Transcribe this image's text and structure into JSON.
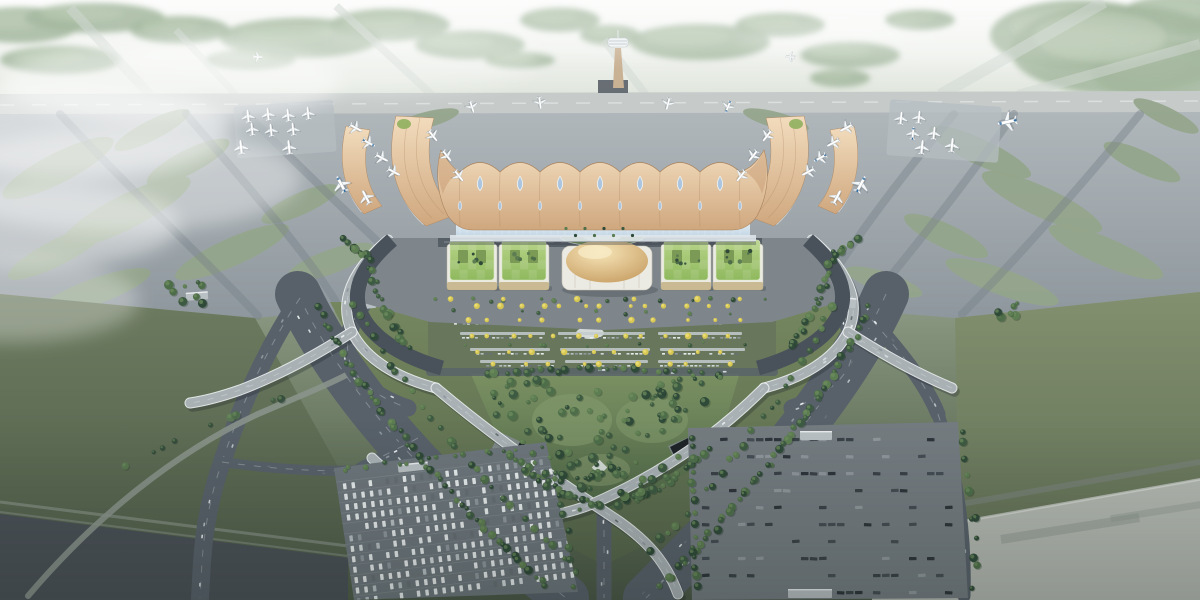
{
  "meta": {
    "description": "Aerial rendering of an airport: wavy gold-roofed terminal with teardrop skylights, curved gold piers with parked jets, golden dome and green-roof landside buildings, tree-lined V-shaped approach roads and flyovers, car park, bus depot, runways and green airfield"
  },
  "palette": {
    "runway": "#c6cbca",
    "apron_top": "#b0b7bb",
    "apron_bottom": "#8e979d",
    "infield": "#94a58b",
    "taxiway": "#78828a",
    "roof_hi": "#f2dcbd",
    "roof": "#cfa77e",
    "roof_dark": "#b08a64",
    "skylight": "#a9c6e2",
    "glass": "#c2d6e4",
    "dome_hi": "#f7e5b8",
    "dome": "#c49a5e",
    "green_roof_hi": "#b8d489",
    "green_roof": "#8fb95e",
    "building_white": "#ecebe3",
    "road_dark": "#49525a",
    "road_mid": "#58616a",
    "lane": "#d4dbdf",
    "deck": "#a9b1b5",
    "forest": "#9cb297",
    "park_hi": "#7b9163",
    "park": "#4e6647",
    "lawn": "#6f8159",
    "field_left_hi": "#6d7b60",
    "field_left": "#4e5c49",
    "field_right_hi": "#82906f",
    "field_right": "#5d6b52",
    "lot_west": "#6d767c",
    "lot_east": "#747c81",
    "strip_dark": "#4a5157",
    "strip_light": "#b4b9b2",
    "tower_shaft": "#c9b193",
    "plane_body": "#f4f7f8",
    "plane_blue": "#2e6da4",
    "tree_colors": [
      "#2f4a39",
      "#3d5a42",
      "#4e6e4a",
      "#5d7d52"
    ],
    "tree_hi": "#6f8f5e",
    "yellow_tree": "#d6c654",
    "yellow_tree_hi": "#e9dc72",
    "car_colors": [
      "#e8eced",
      "#d3d9dc",
      "#b8c0c5",
      "#8f989e",
      "#676f75"
    ],
    "bus_colors": [
      "#2e353b",
      "#3a4248",
      "#454d54",
      "#8f979c"
    ],
    "canopy": "#c3cacd"
  },
  "scene": {
    "forest": [
      [
        20,
        25,
        60,
        18
      ],
      [
        95,
        18,
        70,
        15
      ],
      [
        180,
        30,
        50,
        14
      ],
      [
        300,
        38,
        80,
        20
      ],
      [
        390,
        25,
        60,
        16
      ],
      [
        470,
        45,
        55,
        14
      ],
      [
        560,
        20,
        40,
        12
      ],
      [
        610,
        35,
        30,
        10
      ],
      [
        700,
        42,
        70,
        18
      ],
      [
        780,
        25,
        45,
        12
      ],
      [
        850,
        55,
        50,
        13
      ],
      [
        920,
        20,
        35,
        10
      ],
      [
        1080,
        35,
        90,
        35
      ],
      [
        1160,
        70,
        70,
        30
      ],
      [
        1180,
        15,
        60,
        20
      ],
      [
        60,
        60,
        60,
        14
      ],
      [
        250,
        60,
        45,
        10
      ],
      [
        520,
        60,
        35,
        8
      ],
      [
        1120,
        50,
        110,
        45
      ],
      [
        840,
        78,
        30,
        9
      ]
    ],
    "strips": [
      [
        150,
        95,
        70,
        8,
        10
      ],
      [
        432,
        95,
        336,
        6,
        8
      ],
      [
        646,
        95,
        604,
        40,
        8
      ],
      [
        940,
        95,
        1104,
        2,
        12
      ],
      [
        1018,
        95,
        1200,
        44,
        10
      ],
      [
        236,
        95,
        176,
        30,
        7
      ]
    ],
    "islands": [
      [
        58,
        168,
        62,
        15,
        -27
      ],
      [
        126,
        212,
        72,
        17,
        -27
      ],
      [
        58,
        252,
        56,
        13,
        -27
      ],
      [
        188,
        162,
        46,
        12,
        -27
      ],
      [
        232,
        252,
        62,
        14,
        -24
      ],
      [
        152,
        130,
        42,
        10,
        -27
      ],
      [
        300,
        204,
        42,
        11,
        -24
      ],
      [
        330,
        262,
        46,
        12,
        -20
      ],
      [
        94,
        292,
        60,
        13,
        -20
      ],
      [
        980,
        152,
        56,
        13,
        25
      ],
      [
        1042,
        202,
        66,
        15,
        25
      ],
      [
        1106,
        252,
        62,
        14,
        23
      ],
      [
        946,
        236,
        46,
        12,
        25
      ],
      [
        1142,
        162,
        42,
        11,
        25
      ],
      [
        1166,
        116,
        36,
        9,
        26
      ],
      [
        1002,
        282,
        60,
        13,
        20
      ],
      [
        884,
        282,
        40,
        10,
        18
      ],
      [
        426,
        120,
        34,
        8,
        -15
      ],
      [
        776,
        120,
        34,
        8,
        15
      ]
    ],
    "taxiways": [
      "M246,114 C304,170 366,232 436,296",
      "M186,114 C244,182 306,252 336,302",
      "M954,114 C898,180 846,250 818,300",
      "M1014,114 C962,188 906,258 866,306",
      "M60,114 C130,190 210,264 258,316",
      "M1140,114 C1076,192 1010,266 962,314"
    ],
    "pads": [
      [
        235,
        103,
        100,
        52,
        -4
      ],
      [
        888,
        103,
        112,
        56,
        4
      ]
    ],
    "aircraft": [
      [
        248,
        116,
        -6,
        1,
        "w"
      ],
      [
        268,
        114,
        -6,
        1,
        "w"
      ],
      [
        288,
        115,
        -6,
        1,
        "w"
      ],
      [
        308,
        113,
        -6,
        1,
        "w"
      ],
      [
        252,
        129,
        -6,
        1,
        "w"
      ],
      [
        271,
        130,
        -6,
        1,
        "w"
      ],
      [
        293,
        129,
        -6,
        1,
        "w"
      ],
      [
        241,
        147,
        -6,
        1.1,
        "w"
      ],
      [
        289,
        147,
        -6,
        1.1,
        "w"
      ],
      [
        901,
        118,
        6,
        1,
        "w"
      ],
      [
        919,
        117,
        6,
        1,
        "w"
      ],
      [
        913,
        133,
        6,
        1,
        "b"
      ],
      [
        934,
        133,
        6,
        1,
        "w"
      ],
      [
        922,
        147,
        6,
        1.1,
        "w"
      ],
      [
        952,
        145,
        6,
        1.1,
        "w"
      ],
      [
        1007,
        122,
        -102,
        1.5,
        "b"
      ],
      [
        258,
        57,
        92,
        0.75,
        "w"
      ],
      [
        790,
        57,
        -88,
        0.75,
        "w"
      ],
      [
        356,
        128,
        118,
        1.05,
        "w"
      ],
      [
        369,
        143,
        118,
        1.05,
        "b"
      ],
      [
        382,
        158,
        118,
        1.05,
        "w"
      ],
      [
        394,
        172,
        118,
        1.05,
        "w"
      ],
      [
        341,
        184,
        -28,
        1.35,
        "b"
      ],
      [
        366,
        197,
        -28,
        1.15,
        "w"
      ],
      [
        846,
        128,
        -118,
        1.05,
        "w"
      ],
      [
        833,
        143,
        -118,
        1.05,
        "w"
      ],
      [
        820,
        158,
        -118,
        1.05,
        "b"
      ],
      [
        808,
        172,
        -118,
        1.05,
        "w"
      ],
      [
        861,
        184,
        28,
        1.35,
        "b"
      ],
      [
        837,
        197,
        28,
        1.15,
        "w"
      ],
      [
        472,
        107,
        162,
        0.95,
        "w"
      ],
      [
        540,
        103,
        172,
        0.95,
        "w"
      ],
      [
        668,
        104,
        -166,
        0.95,
        "w"
      ],
      [
        728,
        107,
        -158,
        0.95,
        "b"
      ],
      [
        433,
        136,
        142,
        1,
        "w"
      ],
      [
        447,
        156,
        142,
        1,
        "w"
      ],
      [
        459,
        176,
        142,
        1,
        "w"
      ],
      [
        767,
        136,
        -142,
        1,
        "w"
      ],
      [
        753,
        156,
        -142,
        1,
        "w"
      ],
      [
        741,
        176,
        -142,
        1,
        "w"
      ]
    ],
    "roof": {
      "valleys": [
        460,
        500,
        540,
        580,
        620,
        660,
        700,
        740
      ],
      "peaks": [
        480,
        520,
        560,
        600,
        640,
        680,
        720
      ],
      "drop_top_y": 184,
      "drop_bot_y": 206
    },
    "buildings": {
      "green": [
        [
          472,
          266
        ],
        [
          524,
          266
        ],
        [
          686,
          266
        ],
        [
          738,
          266
        ]
      ]
    },
    "roads": [
      {
        "d": "M298,294 C340,384 424,484 566,598",
        "w": 46,
        "cars": 24
      },
      {
        "d": "M886,294 C846,384 762,484 646,598",
        "w": 46,
        "cars": 24
      },
      {
        "d": "M300,298 C272,340 244,396 222,462 C210,496 204,532 202,562 L200,598",
        "w": 18,
        "cars": 7
      },
      {
        "d": "M418,438 C396,450 378,458 360,468",
        "w": 11,
        "cars": 3
      },
      {
        "d": "M872,320 C902,354 926,384 938,414",
        "w": 15,
        "cars": 5
      },
      {
        "d": "M938,414 C956,470 966,532 964,596",
        "w": 13,
        "cars": 4
      },
      {
        "d": "M604,514 L604,598",
        "w": 15,
        "cars": 3
      },
      {
        "d": "M28,596 C96,516 176,452 258,414 C300,396 330,384 352,372",
        "w": 6,
        "c": "#8c958d",
        "cars": 0,
        "o": 0.85
      },
      {
        "d": "M392,300 L810,300",
        "w": 11,
        "cars": 6
      },
      {
        "d": "M366,300 C350,322 342,346 352,368 C362,386 384,400 408,408",
        "w": 17,
        "cars": 6
      },
      {
        "d": "M834,300 C850,322 858,346 848,368 C838,386 816,400 792,408",
        "w": 17,
        "cars": 6
      },
      {
        "d": "M430,372 L774,372",
        "w": 8,
        "cars": 4,
        "o": 0.8
      },
      {
        "d": "M222,462 C280,470 330,472 356,470",
        "w": 10,
        "cars": 3
      }
    ],
    "viaducts": [
      {
        "d": "M388,240 C352,270 338,302 352,332 C366,360 398,378 436,388",
        "cars": 5
      },
      {
        "d": "M812,240 C848,270 862,302 848,332 C834,360 802,378 764,388",
        "cars": 5
      },
      {
        "d": "M352,332 C318,354 282,374 240,390 C220,397 204,401 190,403",
        "cars": 4
      },
      {
        "d": "M848,332 C882,354 918,374 952,388",
        "cars": 4
      },
      {
        "d": "M436,388 C500,442 560,482 620,522 C648,542 666,562 678,594",
        "cars": 6
      },
      {
        "d": "M764,388 C712,440 652,478 592,504 C552,520 502,524 454,508",
        "cars": 6
      },
      {
        "d": "M454,508 C424,498 394,480 372,458",
        "cars": 2
      }
    ],
    "median": {
      "canopy_rows": [
        {
          "y": 304,
          "segs": [
            [
              468,
              556
            ],
            [
              566,
              652
            ],
            [
              662,
              746
            ]
          ]
        },
        {
          "y": 318,
          "segs": [
            [
              452,
              540
            ],
            [
              552,
              640
            ],
            [
              652,
              740
            ]
          ]
        },
        {
          "y": 332,
          "segs": [
            [
              460,
              545
            ],
            [
              558,
              645
            ],
            [
              658,
              742
            ]
          ]
        },
        {
          "y": 348,
          "segs": [
            [
              470,
              550
            ],
            [
              560,
              650
            ],
            [
              660,
              745
            ]
          ]
        },
        {
          "y": 360,
          "segs": [
            [
              480,
              555
            ],
            [
              565,
              648
            ],
            [
              658,
              735
            ]
          ]
        }
      ]
    },
    "yellow_rows": [
      {
        "y": 306,
        "x0": 466,
        "x1": 744,
        "n": 13
      },
      {
        "y": 320,
        "x0": 452,
        "x1": 748,
        "n": 11
      },
      {
        "y": 336,
        "x0": 458,
        "x1": 744,
        "n": 13
      },
      {
        "y": 352,
        "x0": 466,
        "x1": 742,
        "n": 10
      },
      {
        "y": 364,
        "x0": 478,
        "x1": 736,
        "n": 9
      },
      {
        "y": 299,
        "x0": 430,
        "x1": 772,
        "n": 6
      }
    ],
    "tree_belts": [
      {
        "d": "M318,306 C352,382 420,470 548,588",
        "n": 50
      },
      {
        "d": "M352,300 C392,374 458,462 578,572",
        "n": 26
      },
      {
        "d": "M870,306 C836,382 772,470 660,588",
        "n": 50
      },
      {
        "d": "M836,300 C798,374 744,458 642,558",
        "n": 24
      },
      {
        "d": "M480,374 C560,368 650,368 728,376",
        "n": 26
      },
      {
        "d": "M506,452 C544,486 576,502 606,508",
        "n": 20
      },
      {
        "d": "M710,450 C676,480 646,496 614,506",
        "n": 18
      },
      {
        "d": "M368,252 C372,286 388,322 410,348",
        "n": 20
      },
      {
        "d": "M832,252 C828,286 812,322 790,348",
        "n": 20
      },
      {
        "d": "M340,236 C352,244 360,252 364,258",
        "n": 8
      },
      {
        "d": "M860,236 C848,244 840,252 836,258",
        "n": 8
      },
      {
        "d": "M336,470 L544,446",
        "n": 15,
        "r0": 1.5,
        "r1": 3
      },
      {
        "d": "M550,450 C562,498 570,546 576,590",
        "n": 11
      },
      {
        "d": "M692,434 L696,594",
        "n": 15
      },
      {
        "d": "M960,420 C972,478 977,538 974,594",
        "n": 12
      },
      {
        "d": "M120,472 C180,432 242,408 300,394",
        "n": 9,
        "o": 0.8
      },
      {
        "d": "M430,300 L774,300",
        "n": 14,
        "r0": 1.4,
        "r1": 2.6
      },
      {
        "d": "M452,312 L760,312",
        "n": 8,
        "r0": 1.2,
        "r1": 2.2
      },
      {
        "d": "M456,344 L756,344",
        "n": 10,
        "r0": 1.2,
        "r1": 2.2
      }
    ],
    "clumps": [
      {
        "x": 520,
        "y": 390,
        "w": 160,
        "h": 90,
        "n": 60
      },
      {
        "x": 492,
        "y": 376,
        "w": 60,
        "h": 40,
        "n": 16
      },
      {
        "x": 652,
        "y": 378,
        "w": 70,
        "h": 44,
        "n": 18
      },
      {
        "x": 560,
        "y": 470,
        "w": 90,
        "h": 40,
        "n": 24
      },
      {
        "x": 168,
        "y": 282,
        "w": 36,
        "h": 22,
        "n": 8
      },
      {
        "x": 996,
        "y": 300,
        "w": 30,
        "h": 18,
        "n": 6
      }
    ],
    "canopies": [
      [
        352,
        300,
        24,
        9,
        -6
      ],
      [
        830,
        297,
        26,
        10,
        6
      ],
      [
        398,
        463,
        30,
        8,
        -6
      ],
      [
        800,
        431,
        32,
        9,
        0
      ],
      [
        788,
        589,
        44,
        9,
        0
      ],
      [
        186,
        292,
        22,
        8,
        -4
      ]
    ],
    "mist": [
      [
        70,
        130,
        160,
        48,
        0.5
      ],
      [
        40,
        225,
        140,
        42,
        0.42
      ],
      [
        170,
        82,
        170,
        42,
        0.46
      ],
      [
        120,
        180,
        180,
        52,
        0.36
      ],
      [
        10,
        300,
        130,
        42,
        0.3
      ],
      [
        330,
        62,
        210,
        34,
        0.3
      ],
      [
        620,
        30,
        300,
        26,
        0.25
      ],
      [
        960,
        40,
        220,
        26,
        0.2
      ]
    ],
    "west_lot": {
      "poly": "334,468 546,442 578,592 354,600",
      "rot": -7,
      "cx": 456,
      "cy": 520,
      "y0": 470,
      "y1": 592,
      "dy": 10.5,
      "x0": 348,
      "x1": 566,
      "dx": 8.6,
      "presence": 0.85
    },
    "east_lot": {
      "poly": "688,428 958,422 968,598 692,600",
      "y0": 438,
      "y1": 592,
      "dy": 17,
      "x0": 702,
      "x1": 950,
      "dx": 9,
      "presence": 0.3
    }
  }
}
